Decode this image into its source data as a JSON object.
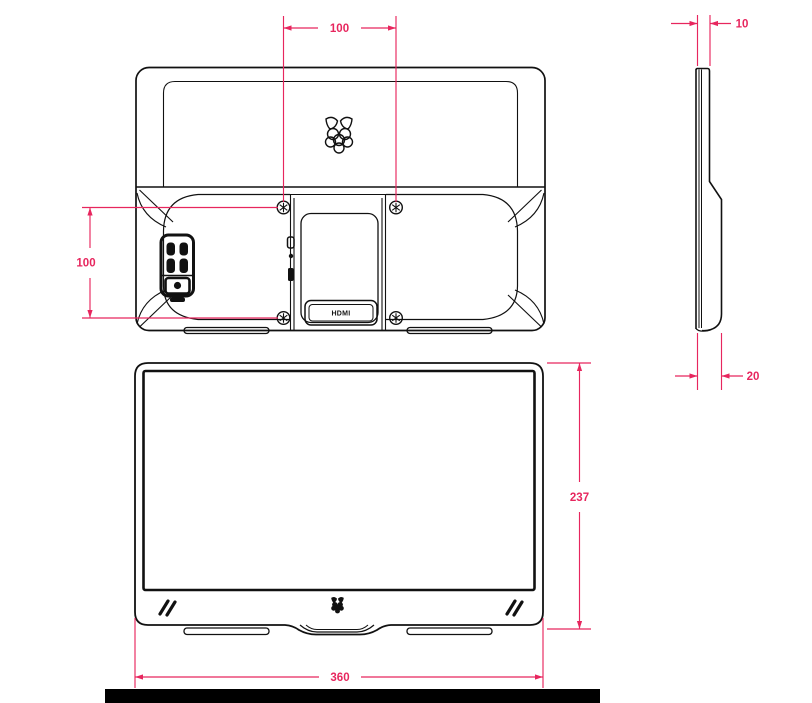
{
  "drawing": {
    "background_color": "#ffffff",
    "line_color": "#111111",
    "dimension_color": "#e7265e",
    "footer_bar_color": "#000000",
    "dimensions": {
      "vesa_horizontal": "100",
      "vesa_vertical": "100",
      "side_top_thickness": "10",
      "side_bottom_thickness": "20",
      "front_height": "237",
      "front_width": "360"
    },
    "port_label": "HDMI",
    "icons": {
      "rear_logo": "raspberry-pi-logo-outline-icon",
      "front_logo": "raspberry-pi-logo-icon",
      "bezel_accent": "double-slash-icon",
      "vesa_screw": "screw-head-icon",
      "power_button": "power-button-icon",
      "rocker_buttons": "rocker-button-icon"
    }
  }
}
